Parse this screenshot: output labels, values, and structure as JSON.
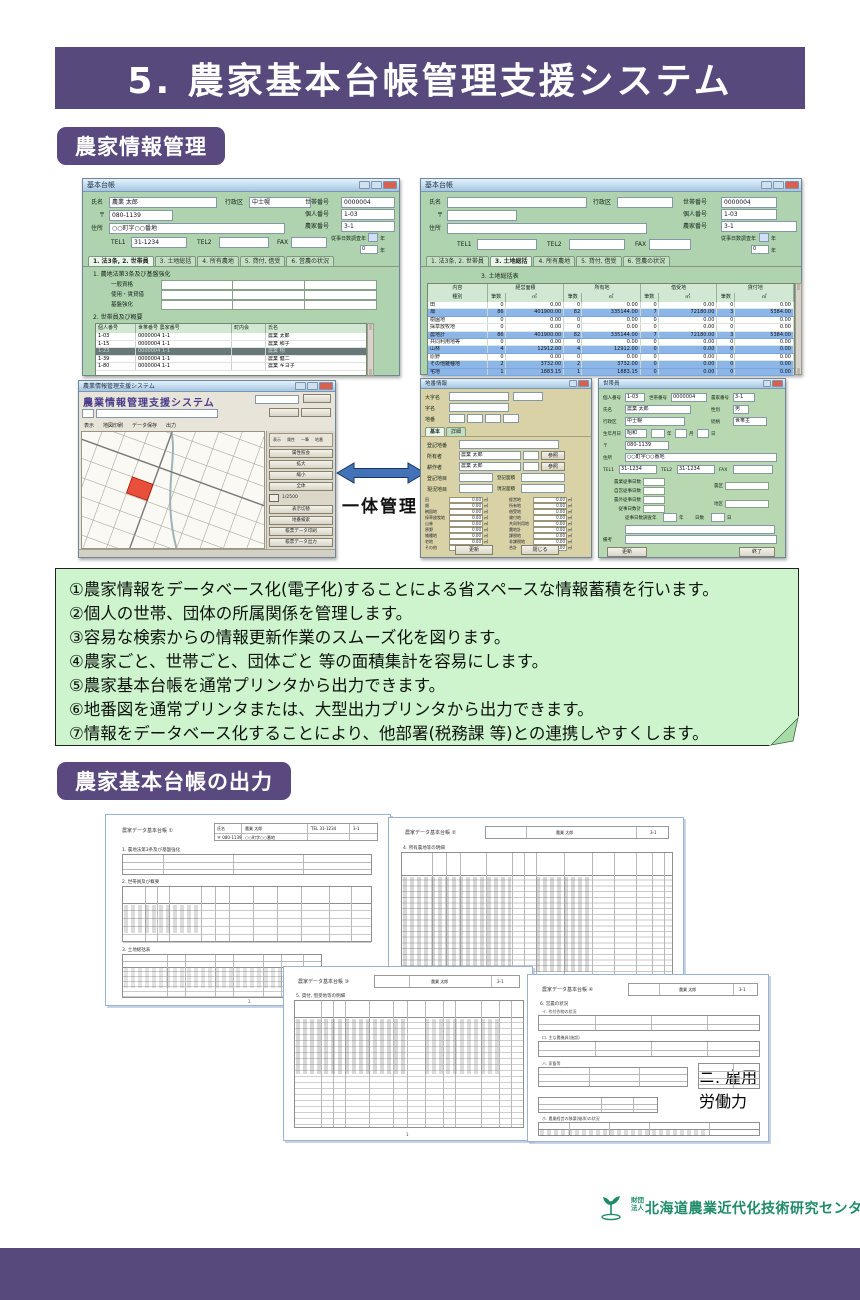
{
  "page": {
    "header_title": "5. 農家基本台帳管理支援システム",
    "section1_badge": "農家情報管理",
    "section2_badge": "農家基本台帳の出力",
    "integration_label": "一体管理",
    "footer": {
      "org_type_line1": "財団",
      "org_type_line2": "法人",
      "org_name": "北海道農業近代化技術研究センター"
    }
  },
  "info_box": {
    "items": [
      "①農家情報をデータベース化(電子化)することによる省スペースな情報蓄積を行います。",
      "②個人の世帯、団体の所属関係を管理します。",
      "③容易な検索からの情報更新作業のスムーズ化を図ります。",
      "④農家ごと、世帯ごと、団体ごと 等の面積集計を容易にします。",
      "⑤農家基本台帳を通常プリンタから出力できます。",
      "⑥地番図を通常プリンタまたは、大型出力プリンタから出力できます。",
      "⑦情報をデータベース化することにより、他部署(税務課 等)との連携しやすくします。"
    ]
  },
  "ledger": {
    "window_title": "基本台帳",
    "labels": {
      "name": "氏名",
      "district": "行政区",
      "zip": "〒",
      "address": "住所",
      "tel1": "TEL1",
      "tel2": "TEL2",
      "fax": "FAX",
      "household_no": "世帯番号",
      "person_no": "個人番号",
      "farm_no": "農家番号",
      "survey_year": "従事日数調査年",
      "year": "年"
    }
  },
  "form_a": {
    "values": {
      "name": "農業 太郎",
      "district": "中士幌",
      "zip": "080-1139",
      "address": "○○町字○○番地",
      "tel1": "31-1234",
      "household_no": "0000004",
      "person_no": "1-03",
      "farm_no": "3-1",
      "survey_year2": "0"
    },
    "tabs": [
      {
        "label": "1. 法3条, 2. 世帯員",
        "active": true
      },
      {
        "label": "3. 土地総括",
        "active": false
      },
      {
        "label": "4. 所有農地",
        "active": false
      },
      {
        "label": "5. 貸付, 借受",
        "active": false
      },
      {
        "label": "6. 営農の状況",
        "active": false
      }
    ],
    "section1_title": "1. 農地法第3条及び基盤強化",
    "section1_rows": [
      {
        "label": "一般資格"
      },
      {
        "label": "使用・賃貸借"
      },
      {
        "label": "基盤強化"
      }
    ],
    "section2_title": "2. 世帯員及び概要",
    "member_table": {
      "headers": [
        "個人番号",
        "世帯番号 農家番号",
        "町内会",
        "氏名"
      ],
      "rows": [
        {
          "no": "1-03",
          "hh": "0000004 1-1",
          "cho": "",
          "name": "農業 太郎",
          "selected": false
        },
        {
          "no": "1-15",
          "hh": "0000004 1-1",
          "cho": "",
          "name": "農業 和子",
          "selected": false
        },
        {
          "no": "1-23",
          "hh": "0000004 1-1",
          "cho": "",
          "name": "農業 翔",
          "selected": true
        },
        {
          "no": "1-39",
          "hh": "0000004 1-1",
          "cho": "",
          "name": "農業 健二",
          "selected": false
        },
        {
          "no": "1-80",
          "hh": "0000004 1-1",
          "cho": "",
          "name": "農業 キヨ子",
          "selected": false
        }
      ]
    }
  },
  "form_b": {
    "values": {
      "household_no": "0000004",
      "person_no": "1-03",
      "farm_no": "3-1",
      "survey_year2": "0"
    },
    "tabs": [
      {
        "label": "1. 法3条, 2. 世帯員",
        "active": false
      },
      {
        "label": "3. 土地総括",
        "active": true
      },
      {
        "label": "4. 所有農地",
        "active": false
      },
      {
        "label": "5. 貸付, 借受",
        "active": false
      },
      {
        "label": "6. 営農の状況",
        "active": false
      }
    ],
    "table_title": "3. 土地総括表",
    "land_table": {
      "group_headers": [
        "内容",
        "経営面積",
        "所有地",
        "借受地",
        "貸付地"
      ],
      "sub_headers": [
        "種別",
        "筆数",
        "㎡",
        "筆数",
        "㎡",
        "筆数",
        "㎡",
        "筆数",
        "㎡"
      ],
      "rows": [
        {
          "label": "田",
          "v": [
            "0",
            "0.00",
            "0",
            "0.00",
            "0",
            "0.00",
            "0",
            "0.00"
          ],
          "hl": false
        },
        {
          "label": "畑",
          "v": [
            "86",
            "401900.00",
            "82",
            "335144.00",
            "7",
            "72180.00",
            "3",
            "5384.00"
          ],
          "hl": true
        },
        {
          "label": "樹園地",
          "v": [
            "0",
            "0.00",
            "0",
            "0.00",
            "0",
            "0.00",
            "0",
            "0.00"
          ],
          "hl": false
        },
        {
          "label": "採草放牧地",
          "v": [
            "0",
            "0.00",
            "0",
            "0.00",
            "0",
            "0.00",
            "0",
            "0.00"
          ],
          "hl": false
        },
        {
          "label": "農地計",
          "v": [
            "86",
            "401900.00",
            "82",
            "335144.00",
            "7",
            "72180.00",
            "3",
            "5384.00"
          ],
          "hl": true
        },
        {
          "label": "共同利用地等",
          "v": [
            "0",
            "0.00",
            "0",
            "0.00",
            "0",
            "0.00",
            "0",
            "0.00"
          ],
          "hl": false
        },
        {
          "label": "山林",
          "v": [
            "4",
            "12912.00",
            "4",
            "12912.00",
            "0",
            "0.00",
            "0",
            "0.00"
          ],
          "hl": true
        },
        {
          "label": "原野",
          "v": [
            "0",
            "0.00",
            "0",
            "0.00",
            "0",
            "0.00",
            "0",
            "0.00"
          ],
          "hl": false
        },
        {
          "label": "その他雑種地",
          "v": [
            "2",
            "3732.00",
            "2",
            "3732.00",
            "0",
            "0.00",
            "0",
            "0.00"
          ],
          "hl": true
        },
        {
          "label": "宅地",
          "v": [
            "1",
            "1883.15",
            "1",
            "1883.15",
            "0",
            "0.00",
            "0",
            "0.00"
          ],
          "hl": true
        }
      ]
    }
  },
  "map_window": {
    "title": "農業情報管理支援システム",
    "menu_items": [
      "表示",
      "地図印刷",
      "データ保存",
      "出力"
    ],
    "legend_items": [
      "表示",
      "属性",
      "一筆",
      "地番"
    ],
    "buttons_top": [
      "属性照会",
      "拡大",
      "縮小",
      "全体"
    ],
    "scale_text": "1/2500",
    "buttons_bottom": [
      "表示切替",
      "地番検索",
      "帳票データ印刷",
      "帳票データ出力"
    ]
  },
  "form_c": {
    "window_title": "地番情報",
    "labels": {
      "oaza": "大字名",
      "aza": "字名",
      "chiban": "地番",
      "touki_chiban": "登記地番",
      "t_chimoku": "登記地目",
      "t_menseki": "登記面積",
      "g_chimoku": "現況地目",
      "g_menseki": "現況面積"
    },
    "owner_rows": [
      {
        "label": "所有者",
        "value": "農業 太郎",
        "btn": "参照"
      },
      {
        "label": "耕作者",
        "value": "農業 太郎",
        "btn": "参照"
      }
    ],
    "tabs": [
      {
        "label": "基本",
        "active": true
      },
      {
        "label": "詳細",
        "active": false
      }
    ],
    "area_unit": "㎡",
    "area_left": [
      {
        "label": "田",
        "value": "0.00"
      },
      {
        "label": "畑",
        "value": "0.00"
      },
      {
        "label": "樹園地",
        "value": "0.00"
      },
      {
        "label": "採草放牧地",
        "value": "0.00"
      },
      {
        "label": "山林",
        "value": "0.00"
      },
      {
        "label": "原野",
        "value": "0.00"
      },
      {
        "label": "雑種地",
        "value": "0.00"
      },
      {
        "label": "宅地",
        "value": "0.00"
      },
      {
        "label": "その他",
        "value": "0.00"
      }
    ],
    "area_right": [
      {
        "label": "経営地",
        "value": "0.00"
      },
      {
        "label": "所有地",
        "value": "0.00"
      },
      {
        "label": "借受地",
        "value": "0.00"
      },
      {
        "label": "貸付地",
        "value": "0.00"
      },
      {
        "label": "共同利用地",
        "value": "0.00"
      },
      {
        "label": "農地計",
        "value": "0.00"
      },
      {
        "label": "課税地",
        "value": "0.00"
      },
      {
        "label": "非課税地",
        "value": "0.00"
      },
      {
        "label": "合計",
        "value": "0.00"
      }
    ],
    "buttons": [
      "更新",
      "閉じる"
    ]
  },
  "form_d": {
    "window_title": "世帯員",
    "labels": {
      "person_no": "個人番号",
      "household_no": "世帯番号",
      "farm_no": "農家番号",
      "name": "氏名",
      "gender": "性別",
      "district": "行政区",
      "relation": "続柄",
      "birth": "生年月日",
      "era": "昭和",
      "year": "年",
      "month": "月",
      "day": "日",
      "zip": "〒",
      "address": "住所",
      "tel1": "TEL1",
      "tel2": "TEL2",
      "fax": "FAX",
      "survey": "従事日数調査年",
      "days": "日数",
      "day_unit": "日",
      "note": "備考"
    },
    "values": {
      "person_no": "1-03",
      "household_no": "0000004",
      "farm_no": "3-1",
      "name": "農業 太郎",
      "gender": "男",
      "district": "中士幌",
      "relation": "世帯主",
      "zip": "080-1139",
      "address": "○○町字○○番地",
      "tel1": "31-1234",
      "tel2": "31-1234"
    },
    "mid_rows": [
      {
        "label": "農業従事日数"
      },
      {
        "label": "自営従事日数"
      },
      {
        "label": "農外従事日数"
      },
      {
        "label": "従事日数計"
      }
    ],
    "right_rows": [
      {
        "label": "農区"
      },
      {
        "label": "地区"
      }
    ],
    "buttons": [
      "更新",
      "終了"
    ]
  },
  "reports": {
    "page_no": "1",
    "hdr": {
      "name_label": "氏名",
      "name": "農業 太郎",
      "tel": "TEL 31-1234",
      "zip": "〒 080-1139",
      "addr": "○○町字○○番地",
      "farm_no_label": "農家番号",
      "farm_no": "3-1"
    },
    "docs": [
      {
        "title": "農家データ基本台帳 ①",
        "sections": [
          "1. 農地法第3条及び基盤強化",
          "2. 世帯員及び概要",
          "3. 土地総括表"
        ]
      },
      {
        "title": "農家データ基本台帳 ②",
        "sections": [
          "4. 所有農地等の明細"
        ]
      },
      {
        "title": "農家データ基本台帳 ③",
        "sections": [
          "5. 貸付, 借受地等の明細"
        ]
      },
      {
        "title": "農家データ基本台帳 ④",
        "sections": [
          "6. 営農の状況"
        ],
        "subs": [
          "イ. 作付作物の状況",
          "ロ. 主な農機具(施設)",
          "ハ. 家畜等",
          "ニ. 雇用労働力",
          "ホ. 農業経営の移譲(継承)の状況"
        ]
      }
    ]
  }
}
